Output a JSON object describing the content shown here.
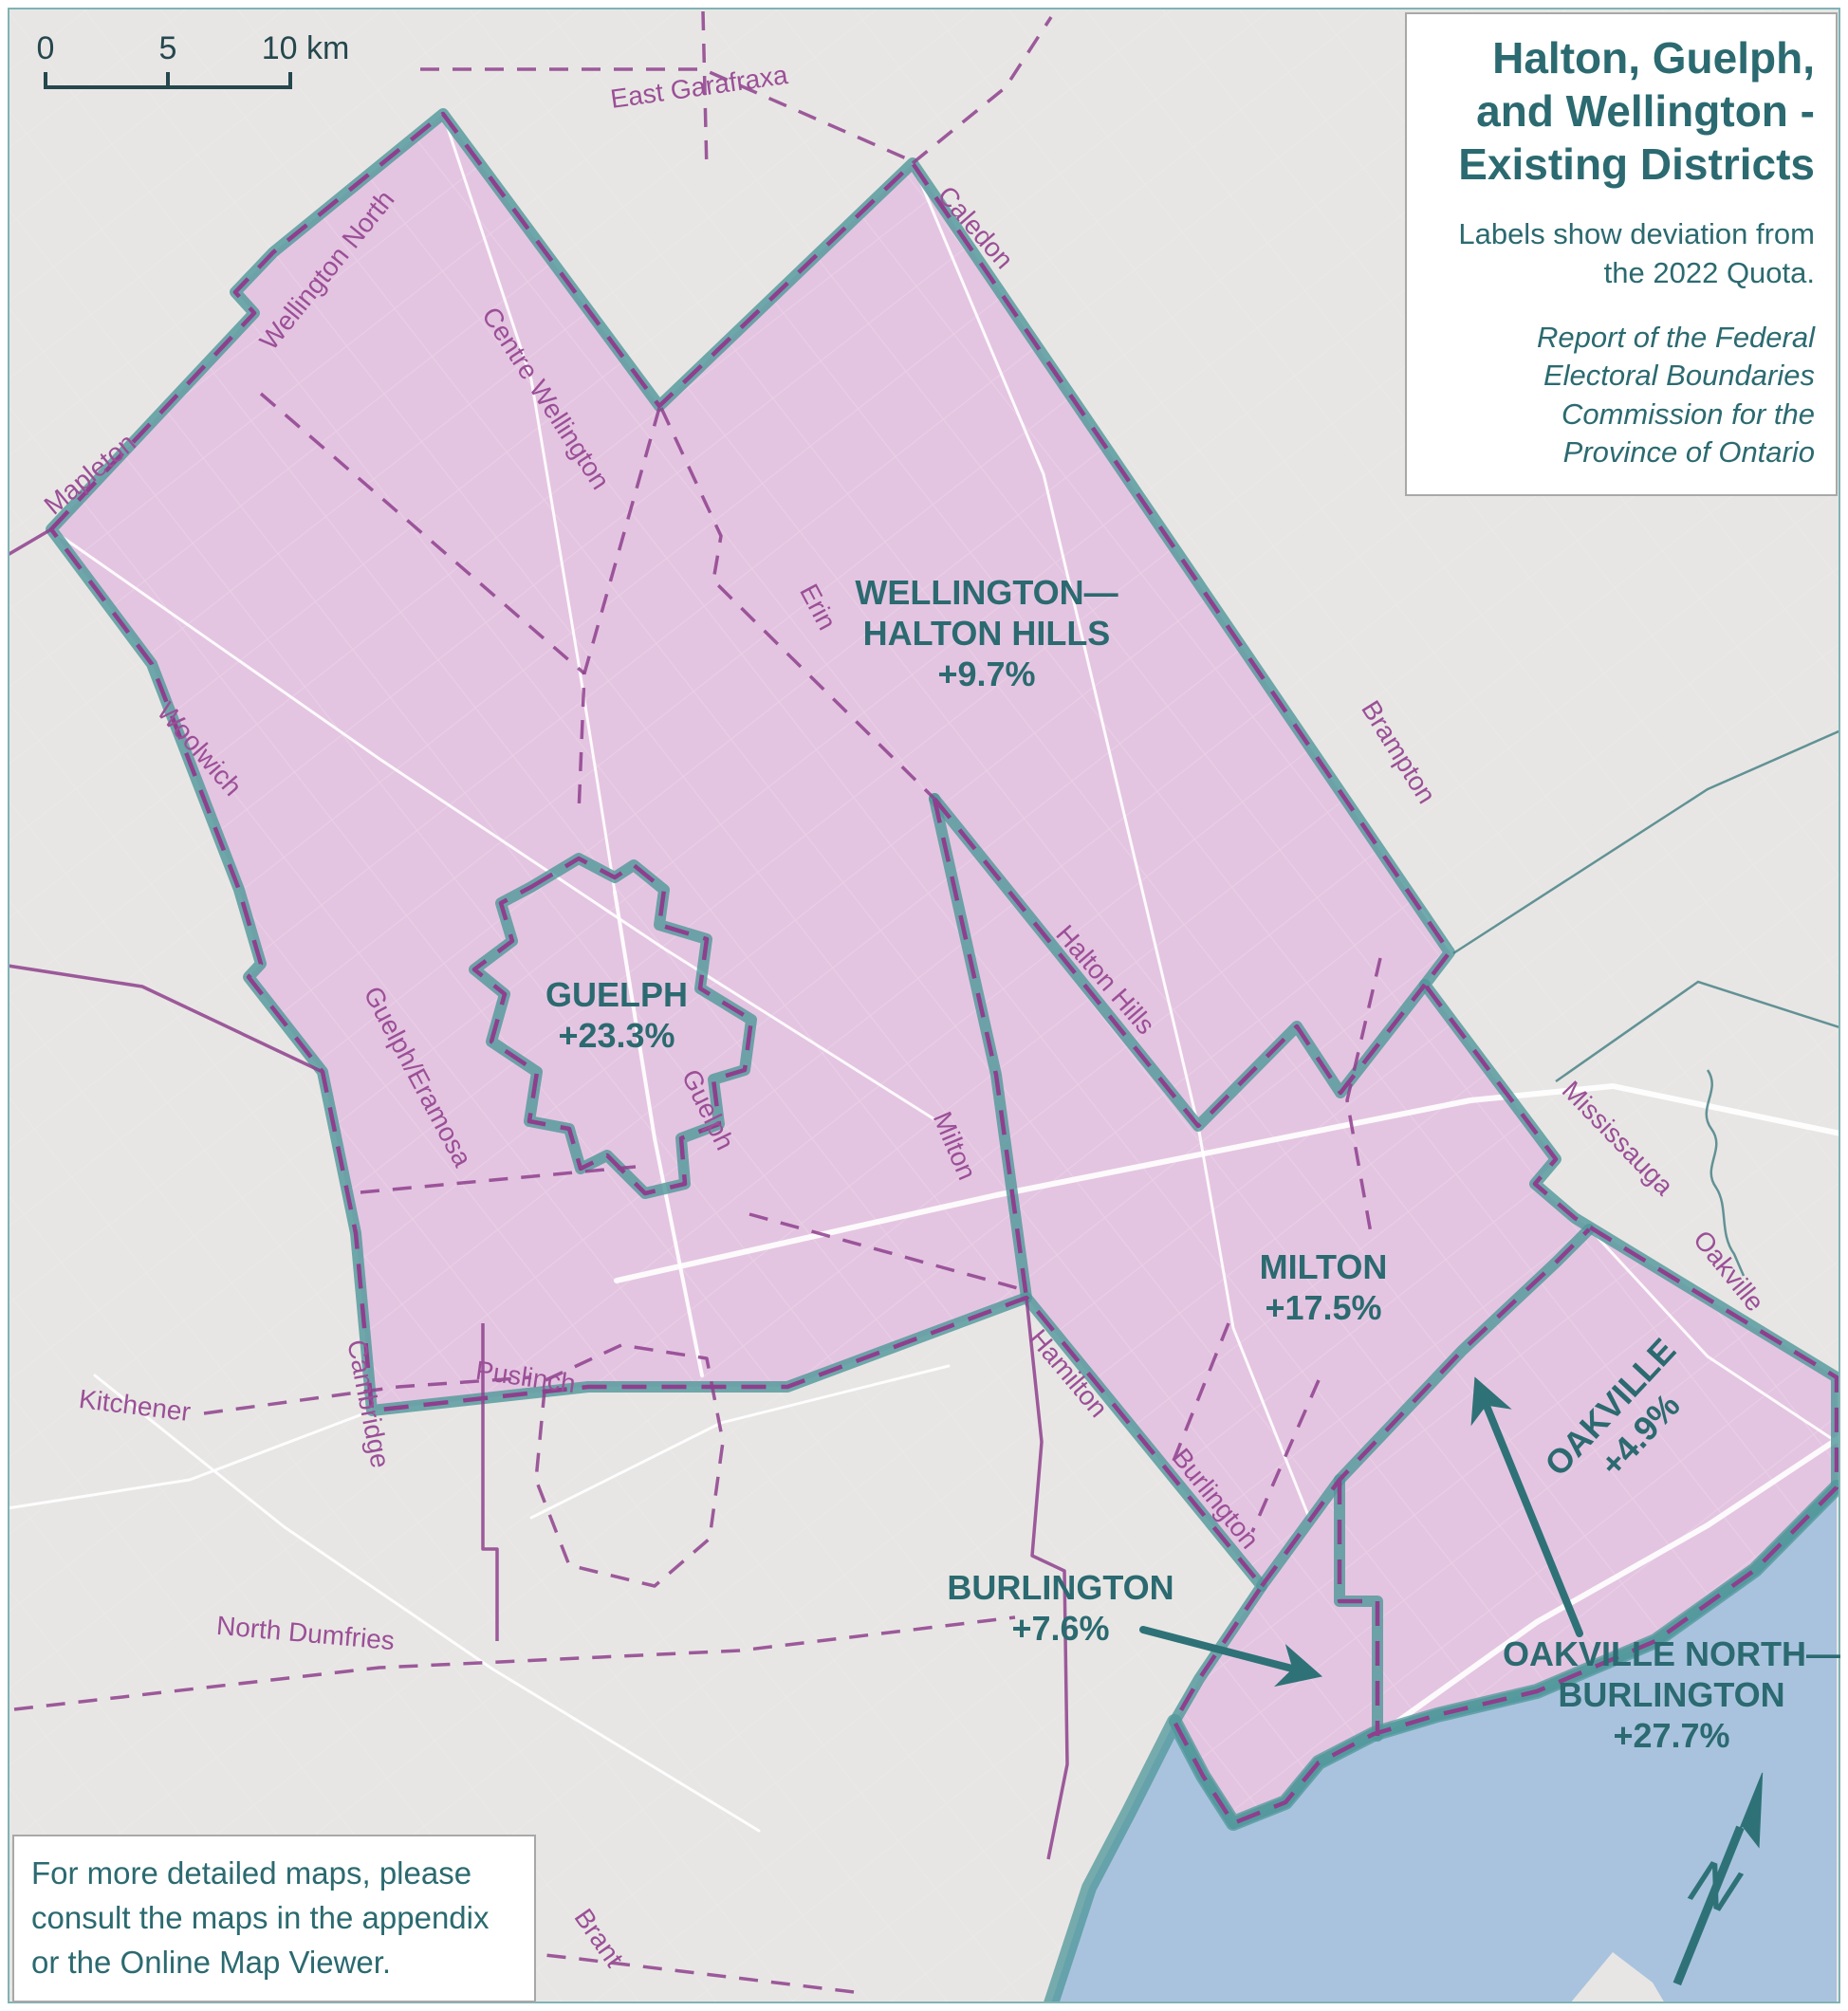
{
  "title_box": {
    "title_lines": [
      "Halton, Guelph,",
      "and Wellington -",
      "Existing Districts"
    ],
    "subtitle_lines": [
      "Labels show deviation from",
      "the 2022 Quota."
    ],
    "source_lines": [
      "Report of the Federal",
      "Electoral Boundaries",
      "Commission for the",
      "Province of Ontario"
    ]
  },
  "scale_bar": {
    "start": "0",
    "mid": "5",
    "end": "10 km"
  },
  "note_box": {
    "lines": [
      "For more detailed maps, please",
      "consult the maps in the appendix",
      "or the Online Map Viewer."
    ]
  },
  "compass": {
    "label": "N"
  },
  "districts": [
    {
      "id": "wellington-halton-hills",
      "lines": [
        "WELLINGTON—",
        "HALTON HILLS"
      ],
      "deviation": "+9.7%"
    },
    {
      "id": "guelph",
      "lines": [
        "GUELPH"
      ],
      "deviation": "+23.3%"
    },
    {
      "id": "milton",
      "lines": [
        "MILTON"
      ],
      "deviation": "+17.5%"
    },
    {
      "id": "oakville",
      "lines": [
        "OAKVILLE"
      ],
      "deviation": "+4.9%"
    },
    {
      "id": "burlington",
      "lines": [
        "BURLINGTON"
      ],
      "deviation": "+7.6%"
    },
    {
      "id": "oakville-north-burlington",
      "lines": [
        "OAKVILLE NORTH—",
        "BURLINGTON"
      ],
      "deviation": "+27.7%"
    }
  ],
  "municipalities": [
    {
      "name": "East Garafraxa"
    },
    {
      "name": "Wellington North"
    },
    {
      "name": "Centre Wellington"
    },
    {
      "name": "Caledon"
    },
    {
      "name": "Mapleton"
    },
    {
      "name": "Woolwich"
    },
    {
      "name": "Erin"
    },
    {
      "name": "Brampton"
    },
    {
      "name": "Halton Hills"
    },
    {
      "name": "Guelph/Eramosa"
    },
    {
      "name": "Guelph"
    },
    {
      "name": "Milton"
    },
    {
      "name": "Mississauga"
    },
    {
      "name": "Oakville"
    },
    {
      "name": "Hamilton"
    },
    {
      "name": "Burlington"
    },
    {
      "name": "Kitchener"
    },
    {
      "name": "Cambridge"
    },
    {
      "name": "Puslinch"
    },
    {
      "name": "North Dumfries"
    },
    {
      "name": "Brant"
    }
  ],
  "colors": {
    "district_fill": "#e4c5e1",
    "district_boundary": "#4f979a",
    "boundary_dash": "#8e3f8d",
    "municipal_label": "#9b4f97",
    "district_label": "#2b6a70",
    "land": "#e8e6e4",
    "lake": "#a9c3de",
    "road": "#ffffff",
    "frame": "#7fb3b5",
    "scale_text": "#25474e",
    "accent": "#2e7277"
  }
}
